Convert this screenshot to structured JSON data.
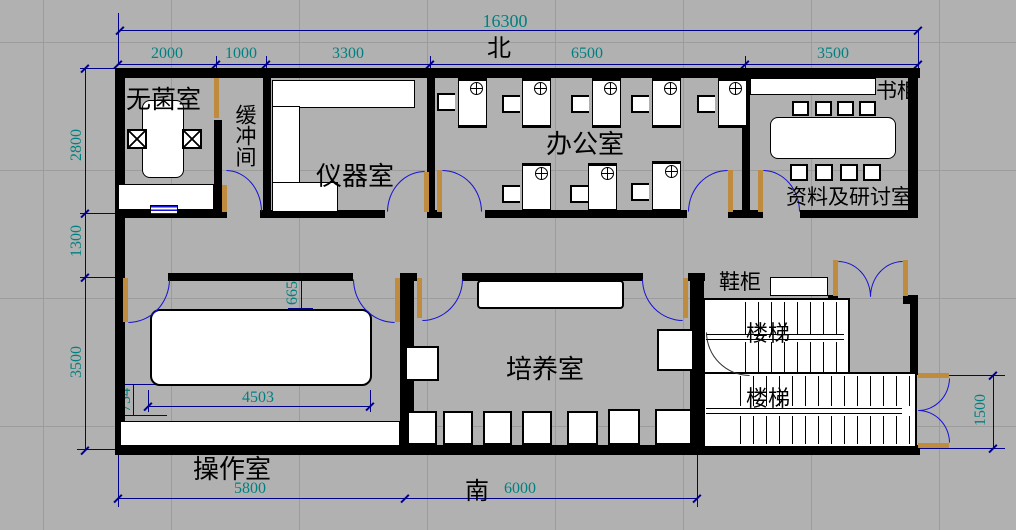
{
  "drawing": {
    "compass_north": "北",
    "compass_south": "南"
  },
  "rooms": {
    "sterile": "无菌室",
    "buffer": "缓冲间",
    "instrument": "仪器室",
    "office": "办公室",
    "archive": "资料及研讨室",
    "bookcase": "书柜",
    "shoe_cabinet": "鞋柜",
    "stairs_upper": "楼梯",
    "stairs_lower": "楼梯",
    "culture": "培养室",
    "operation": "操作室"
  },
  "dims": {
    "total_width": "16300",
    "top": [
      "2000",
      "1000",
      "3300",
      "6500",
      "3500"
    ],
    "left": [
      "2800",
      "1300",
      "3500"
    ],
    "bottom": [
      "5800",
      "6000"
    ],
    "right": "1500",
    "table_width": "4503",
    "bench_offset": "754",
    "shelf_offset": "665"
  },
  "colors": {
    "floor": "#b1b1b1",
    "grid": "#9c9c9c",
    "wall": "#000000",
    "dim_line": "#00008b",
    "dim_text": "#008080",
    "door_leaf": "#bf8b3f",
    "door_arc": "#1612d4",
    "furniture": "#ffffff"
  }
}
